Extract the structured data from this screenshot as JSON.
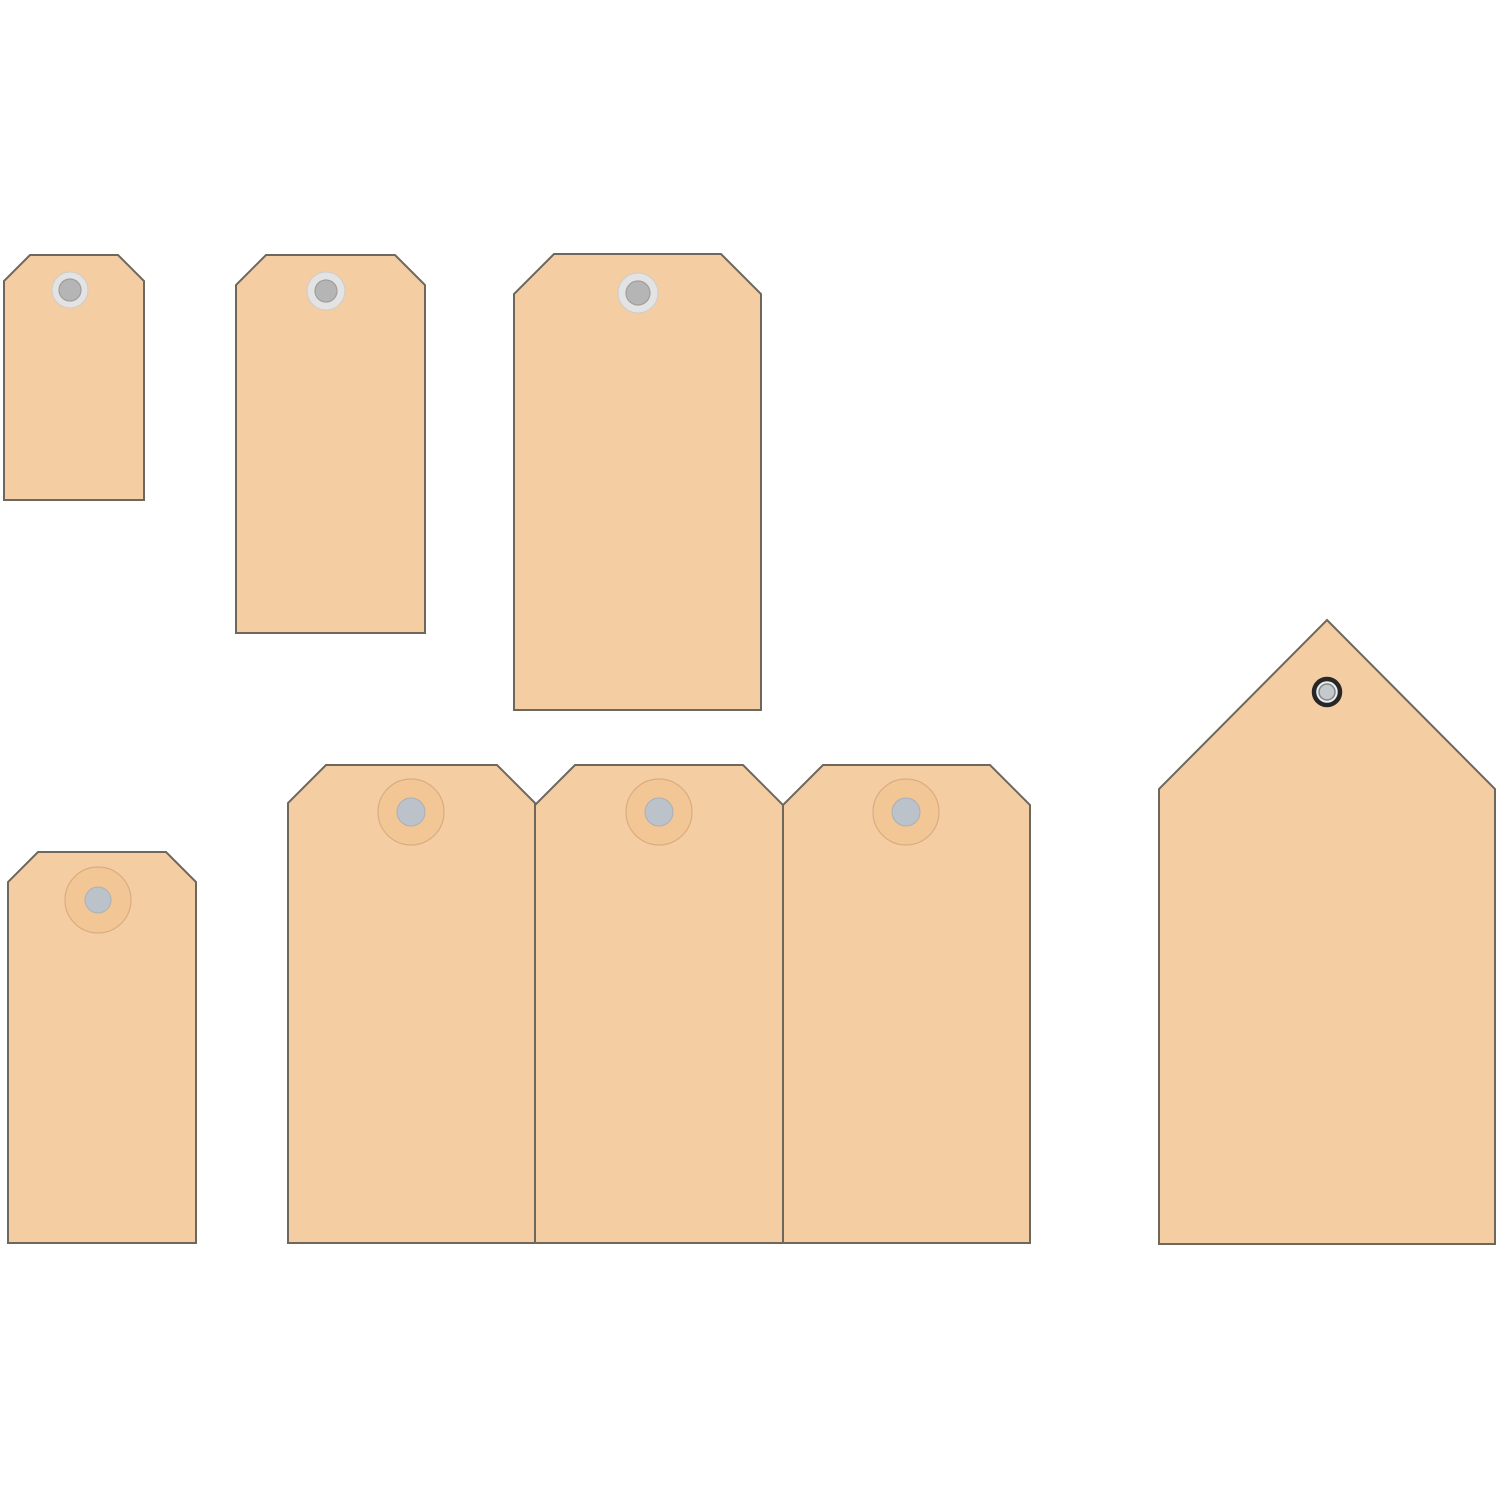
{
  "scene": {
    "description": "Set of eight blank manila shipping tags on a white background",
    "background_color": "#ffffff",
    "canvas_width": 1500,
    "canvas_height": 1500
  },
  "palette": {
    "tag_fill": "#f5cda3",
    "tag_border": "#6e675c",
    "tag_border_width": 2,
    "ring_outer_fill": "#e3e3e3",
    "ring_outer_stroke": "#cccccc",
    "ring_inner_fill": "#b5b5b5",
    "ring_inner_stroke": "#9e9e9e",
    "washer_fill": "#f2c695",
    "washer_stroke": "#d9ad80",
    "washer_center_fill": "#bcc2c9",
    "washer_center_stroke": "#aab0b7",
    "eyelet_ring_fill": "#ededed",
    "eyelet_ring_stroke": "#272727",
    "eyelet_center_fill": "#c4c9cd",
    "eyelet_center_stroke": "#83878b"
  },
  "tags": [
    {
      "id": "tag-small-top-left",
      "shape": "notched",
      "x1": 4,
      "y1": 255,
      "x2": 144,
      "y2": 500,
      "cut": 26,
      "hole": {
        "style": "ring",
        "cx": 70,
        "cy": 290,
        "r_outer": 18,
        "r_inner": 11
      }
    },
    {
      "id": "tag-medium-top",
      "shape": "notched",
      "x1": 236,
      "y1": 255,
      "x2": 425,
      "y2": 633,
      "cut": 30,
      "hole": {
        "style": "ring",
        "cx": 326,
        "cy": 291,
        "r_outer": 19,
        "r_inner": 11
      }
    },
    {
      "id": "tag-large-top",
      "shape": "notched",
      "x1": 514,
      "y1": 254,
      "x2": 761,
      "y2": 710,
      "cut": 40,
      "hole": {
        "style": "ring",
        "cx": 638,
        "cy": 293,
        "r_outer": 20,
        "r_inner": 12
      }
    },
    {
      "id": "tag-small-bottom-left",
      "shape": "notched",
      "x1": 8,
      "y1": 852,
      "x2": 196,
      "y2": 1243,
      "cut": 30,
      "hole": {
        "style": "washer",
        "cx": 98,
        "cy": 900,
        "r_outer": 33,
        "r_inner": 13
      }
    },
    {
      "id": "tag-bottom-row-1",
      "shape": "notched",
      "x1": 288,
      "y1": 765,
      "x2": 535,
      "y2": 1243,
      "cut": 38,
      "hole": {
        "style": "washer",
        "cx": 411,
        "cy": 812,
        "r_outer": 33,
        "r_inner": 14
      }
    },
    {
      "id": "tag-bottom-row-2",
      "shape": "notched",
      "x1": 535,
      "y1": 765,
      "x2": 783,
      "y2": 1243,
      "cut": 40,
      "hole": {
        "style": "washer",
        "cx": 659,
        "cy": 812,
        "r_outer": 33,
        "r_inner": 14
      }
    },
    {
      "id": "tag-bottom-row-3",
      "shape": "notched",
      "x1": 783,
      "y1": 765,
      "x2": 1030,
      "y2": 1243,
      "cut": 40,
      "hole": {
        "style": "washer",
        "cx": 906,
        "cy": 812,
        "r_outer": 33,
        "r_inner": 14
      }
    },
    {
      "id": "tag-pointed-right",
      "shape": "pointed",
      "x1": 1159,
      "y1": 620,
      "x2": 1495,
      "y2": 1244,
      "apex_x": 1327,
      "apex_y": 620,
      "shoulder_y": 789,
      "hole": {
        "style": "eyelet",
        "cx": 1327,
        "cy": 692,
        "r_outer": 13,
        "r_inner": 8
      }
    }
  ]
}
